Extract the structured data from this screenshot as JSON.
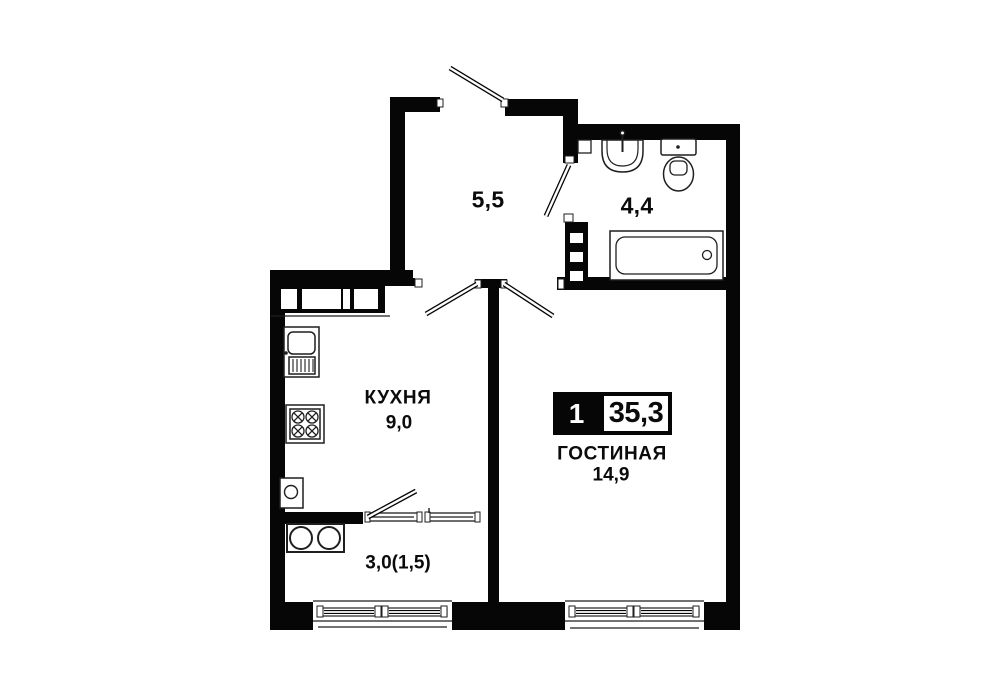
{
  "floorplan": {
    "badge": {
      "room_count": "1",
      "total_area": "35,3"
    },
    "rooms": {
      "hall": {
        "area": "5,5"
      },
      "bathroom": {
        "area": "4,4"
      },
      "kitchen": {
        "name": "КУХНЯ",
        "area": "9,0"
      },
      "living": {
        "name": "ГОСТИНАЯ",
        "area": "14,9"
      },
      "balcony": {
        "area": "3,0(1,5)"
      }
    },
    "colors": {
      "wall": "#060606",
      "background": "#ffffff",
      "fixture_stroke": "#1f1f1f"
    }
  }
}
